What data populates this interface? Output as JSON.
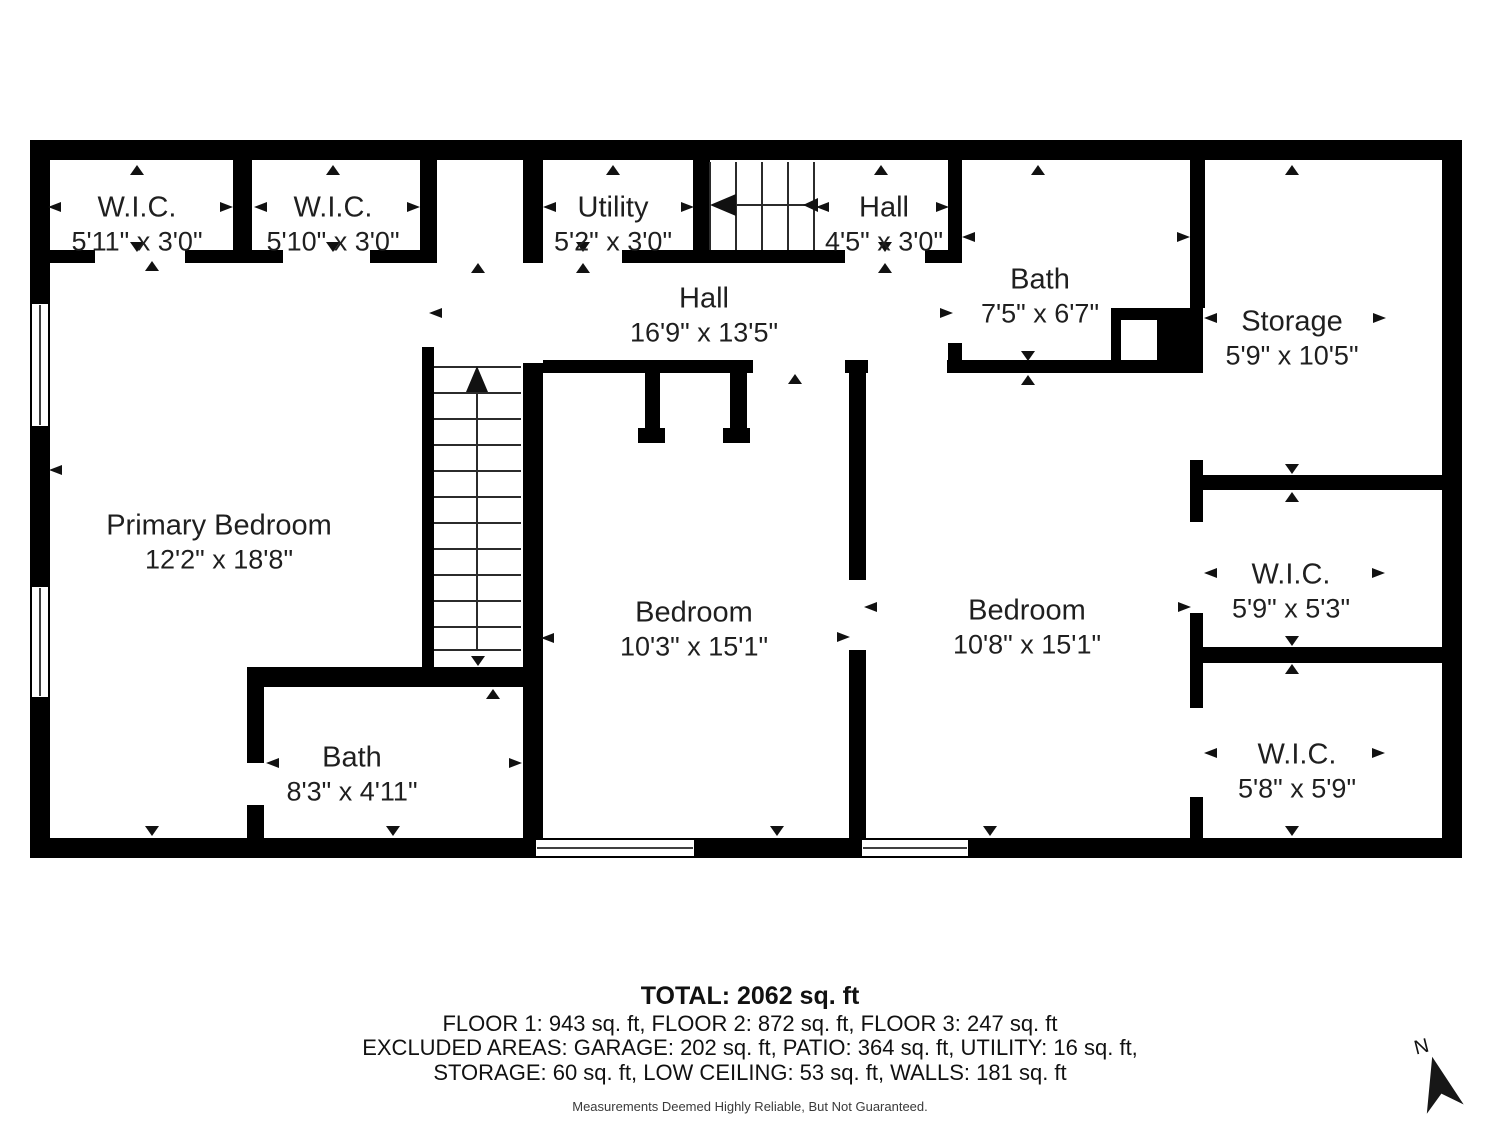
{
  "rooms": [
    {
      "name": "W.I.C.",
      "dims": "5'11\" x 3'0\""
    },
    {
      "name": "W.I.C.",
      "dims": "5'10\" x 3'0\""
    },
    {
      "name": "Utility",
      "dims": "5'2\" x 3'0\""
    },
    {
      "name": "Hall",
      "dims": "4'5\" x 3'0\""
    },
    {
      "name": "Bath",
      "dims": "7'5\" x 6'7\""
    },
    {
      "name": "Storage",
      "dims": "5'9\" x 10'5\""
    },
    {
      "name": "Hall",
      "dims": "16'9\" x 13'5\""
    },
    {
      "name": "Primary Bedroom",
      "dims": "12'2\" x 18'8\""
    },
    {
      "name": "Bedroom",
      "dims": "10'3\" x 15'1\""
    },
    {
      "name": "Bedroom",
      "dims": "10'8\" x 15'1\""
    },
    {
      "name": "W.I.C.",
      "dims": "5'9\" x 5'3\""
    },
    {
      "name": "W.I.C.",
      "dims": "5'8\" x 5'9\""
    },
    {
      "name": "Bath",
      "dims": "8'3\" x 4'11\""
    }
  ],
  "summary": {
    "total": "TOTAL: 2062 sq. ft",
    "floors": "FLOOR 1: 943 sq. ft, FLOOR 2: 872 sq. ft, FLOOR 3: 247 sq. ft",
    "excluded_line1": "EXCLUDED AREAS: GARAGE: 202 sq. ft, PATIO: 364 sq. ft, UTILITY: 16 sq. ft,",
    "excluded_line2": "STORAGE: 60 sq. ft, LOW CEILING: 53 sq. ft, WALLS: 181 sq. ft",
    "disclaimer": "Measurements Deemed Highly Reliable, But Not Guaranteed."
  },
  "compass": {
    "label": "N"
  },
  "colors": {
    "wall": "#000000",
    "text": "#1f1f1f"
  }
}
